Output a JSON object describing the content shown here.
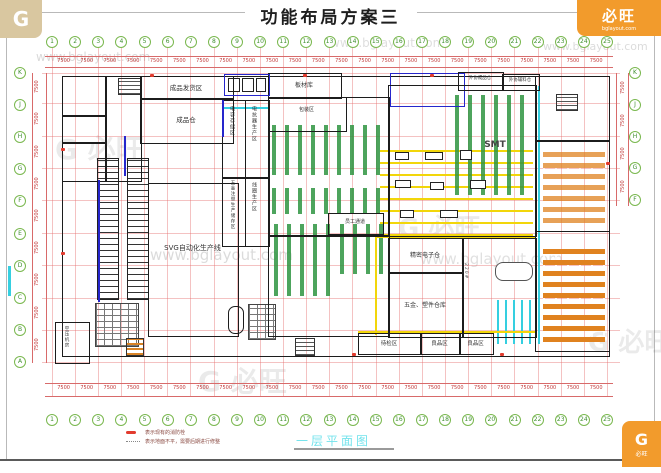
{
  "title": "功能布局方案三",
  "caption": "一层平面图",
  "grid": {
    "top_numbers": [
      "1",
      "2",
      "3",
      "4",
      "5",
      "6",
      "7",
      "8",
      "9",
      "10",
      "11",
      "12",
      "13",
      "14",
      "15",
      "16",
      "17",
      "18",
      "19",
      "20",
      "21",
      "22",
      "23",
      "24",
      "25"
    ],
    "bottom_numbers": [
      "1",
      "2",
      "3",
      "4",
      "5",
      "6",
      "7",
      "8",
      "9",
      "10",
      "11",
      "12",
      "13",
      "14",
      "15",
      "16",
      "17",
      "18",
      "19",
      "20",
      "21",
      "22",
      "23",
      "24",
      "25"
    ],
    "left_letters": [
      "K",
      "J",
      "H",
      "G",
      "F",
      "E",
      "D",
      "C",
      "B",
      "A"
    ],
    "right_letters": [
      "K",
      "J",
      "H",
      "G",
      "F"
    ],
    "top_dims": [
      "7500",
      "7500",
      "7500",
      "7500",
      "7500",
      "7500",
      "7500",
      "7500",
      "7500",
      "7500",
      "7500",
      "7500",
      "7500",
      "7500",
      "7500",
      "7500",
      "7500",
      "7500",
      "7500",
      "7500",
      "7500",
      "7500",
      "7500",
      "7500"
    ],
    "bottom_dims": [
      "7500",
      "7500",
      "7500",
      "7500",
      "7500",
      "7500",
      "7500",
      "7500",
      "7500",
      "7500",
      "7500",
      "7500",
      "7500",
      "7500",
      "7500",
      "7500",
      "7500",
      "7500",
      "7500",
      "7500",
      "7500",
      "7500",
      "7500",
      "7500"
    ],
    "left_dims": [
      "7500",
      "7500",
      "7500",
      "7500",
      "7500",
      "7500",
      "7500",
      "7500",
      "7500"
    ],
    "right_dims": [
      "7500",
      "7500",
      "7500",
      "7500"
    ]
  },
  "rooms": {
    "shipping": "成品发货区",
    "finished_wh": "成品仓",
    "sheet_wh": "板材库",
    "packing": "包装区",
    "outsourced_fg": "外协成品仓",
    "outsourced_mat": "外协辅料仓",
    "svg_line": "SVG自动化生产线",
    "cap_storage": "电容存储区",
    "reactor_prod": "电抗器生产区",
    "hw_injection": "五金注塑生产储存区",
    "coil_prod": "线圈生产区",
    "smt": "SMT",
    "staff_corridor": "员工通道",
    "precision_wh": "精密电子仓",
    "hw_plastic_wh": "五金、塑件仓库",
    "pending_insp": "待检区",
    "good_area_1": "良品区",
    "good_area_2": "良品区",
    "compressor": "空压机房",
    "dock_number": "220#"
  },
  "legend": {
    "items": [
      {
        "text": "表示现有的消防栓"
      },
      {
        "text": "表示地面不平，需要后期进行修整"
      }
    ]
  },
  "watermark": {
    "url": "www.bglayout.com",
    "brand": "必旺",
    "brand_initial": "G",
    "brand_site": "bglayout.com"
  }
}
